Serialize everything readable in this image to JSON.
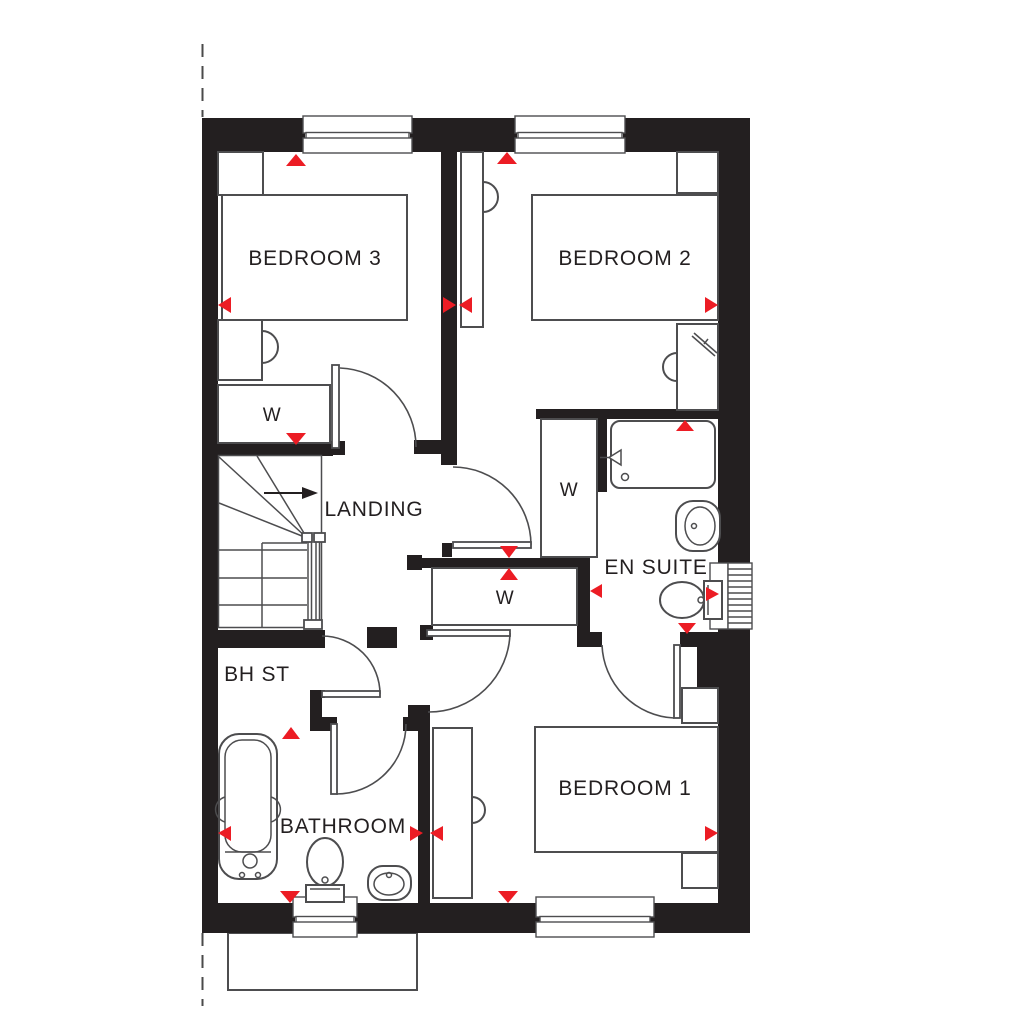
{
  "colors": {
    "wall": "#231f20",
    "line": "#4d4d4f",
    "accent_red": "#ec1c24",
    "background": "#ffffff"
  },
  "rooms": {
    "bedroom3": {
      "label": "BEDROOM 3"
    },
    "bedroom2": {
      "label": "BEDROOM 2"
    },
    "bedroom1": {
      "label": "BEDROOM 1"
    },
    "landing": {
      "label": "LANDING"
    },
    "ensuite": {
      "label": "EN SUITE"
    },
    "bhst": {
      "label": "BH ST"
    },
    "bathroom": {
      "label": "BATHROOM"
    }
  },
  "closets": {
    "bedroom3_wardrobe": "W",
    "landing_wardrobe": "W",
    "bedroom1_wardrobe": "W"
  }
}
